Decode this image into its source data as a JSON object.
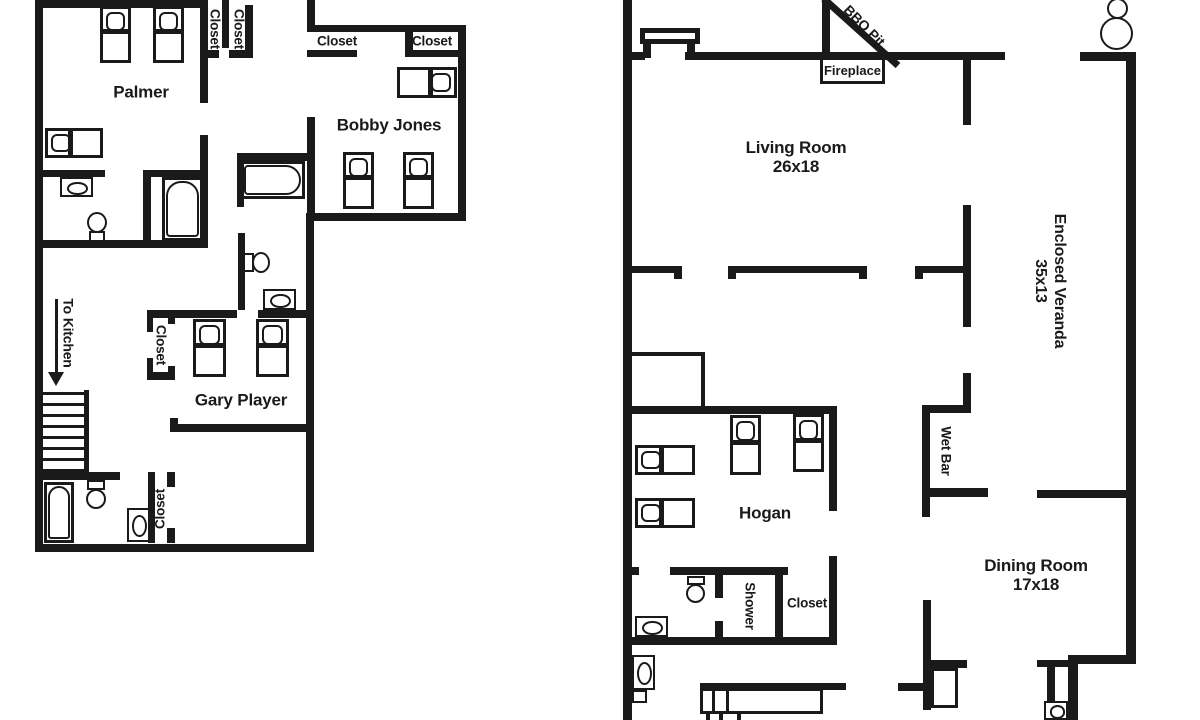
{
  "left_unit": {
    "rooms": {
      "palmer": "Palmer",
      "bobby_jones": "Bobby Jones",
      "gary_player": "Gary Player"
    },
    "annotations": {
      "to_kitchen": "To Kitchen",
      "closet_hall_a": "Closet",
      "closet_hall_b": "Closet",
      "closet_bobby_a": "Closet",
      "closet_bobby_b": "Closet",
      "closet_gary": "Closet",
      "closet_bath": "Closet"
    }
  },
  "right_unit": {
    "rooms": {
      "living_room": {
        "name": "Living Room",
        "size": "26x18"
      },
      "dining_room": {
        "name": "Dining Room",
        "size": "17x18"
      },
      "enclosed_veranda": {
        "name": "Enclosed Veranda",
        "size": "35x13"
      },
      "hogan": {
        "name": "Hogan"
      }
    },
    "annotations": {
      "bbq_pit": "BBQ Pit",
      "fireplace": "Fireplace",
      "wet_bar": "Wet Bar",
      "shower": "Shower",
      "closet": "Closet"
    }
  },
  "colors": {
    "line": "#1a1a1a",
    "background": "#ffffff"
  }
}
